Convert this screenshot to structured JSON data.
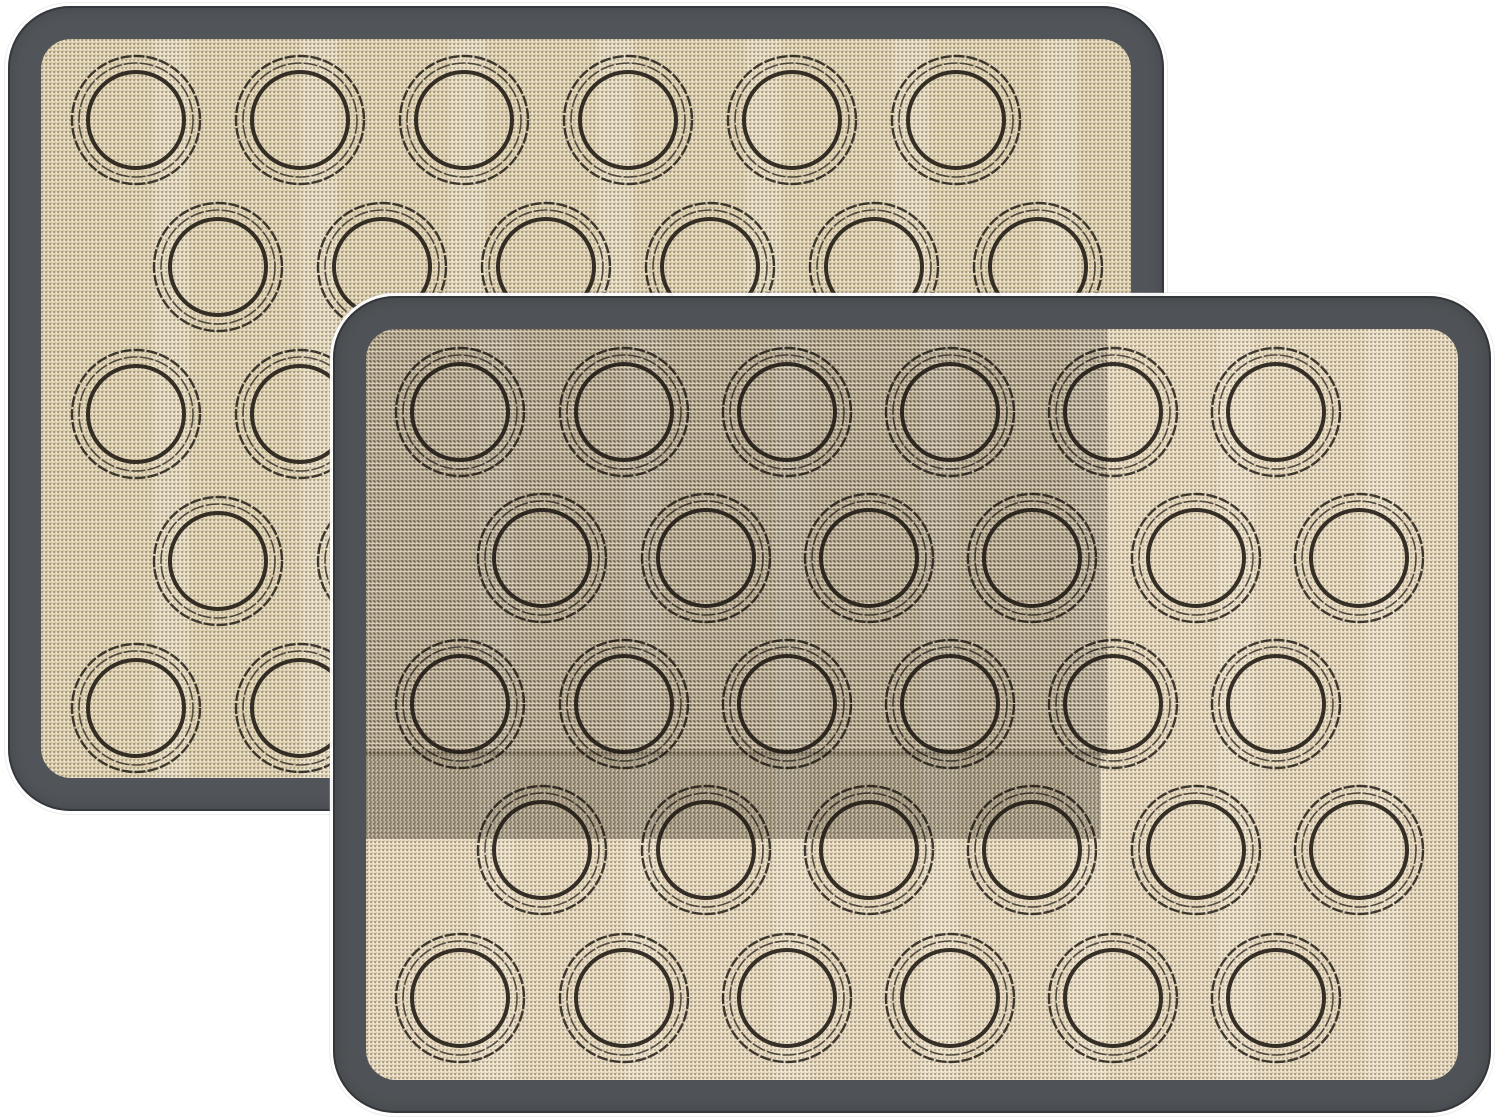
{
  "scene": {
    "type": "product-photo",
    "description": "Two overlapping rectangular silicone macaron baking mats on a white background. Each mat has a dark slate-gray rounded border frame and a speckled beige woven fiberglass surface printed with thirty double-ring macaron piping guide circles arranged in five staggered rows of six. The front mat covers the lower-right portion of the back mat and shows a darker woven moire region over its upper-left area and a denser horizontal band across its middle.",
    "background_color": "#ffffff",
    "image_width": 1498,
    "image_height": 1118,
    "mat_count": 2
  },
  "shared_pattern": {
    "rows": 5,
    "circles_per_row": 6,
    "total_circles_per_mat": 30,
    "row_stagger": "rows 1,3,5 aligned; rows 2,4 offset right by half a pitch",
    "circle_pitch_x": 164,
    "circle_pitch_y": 146,
    "ring_style": "two thin concentric outer rings with one bold inner ring"
  },
  "mats": [
    {
      "id": "back",
      "label": "back baking mat (upper left, partially hidden)",
      "x": 8,
      "y": 6,
      "width": 1156,
      "height": 805,
      "corner_radius": 62,
      "border_color": "#51555a",
      "border_thickness": 33,
      "surface_color": "#ddcfae",
      "surface_corner_radius": 30,
      "ring_color": "#17130e",
      "row_centers_y": [
        114,
        261,
        408,
        555,
        702
      ],
      "odd_row_centers_x": [
        128,
        292,
        456,
        620,
        784,
        948
      ],
      "even_row_centers_x": [
        210,
        374,
        538,
        702,
        866,
        1030
      ],
      "circle_radii": {
        "outer": 64,
        "middle": 57,
        "inner": 48
      },
      "shade_regions": []
    },
    {
      "id": "front",
      "label": "front baking mat (lower right, fully visible)",
      "x": 333,
      "y": 296,
      "width": 1158,
      "height": 817,
      "corner_radius": 62,
      "border_color": "#4f5357",
      "border_thickness": 33,
      "surface_color": "#e8d7b8",
      "surface_corner_radius": 30,
      "ring_color": "#17130e",
      "row_centers_y": [
        116,
        262,
        408,
        554,
        702
      ],
      "odd_row_centers_x": [
        127,
        291,
        454,
        617,
        780,
        943
      ],
      "even_row_centers_x": [
        209,
        373,
        536,
        699,
        863,
        1026
      ],
      "circle_radii": {
        "outer": 64,
        "middle": 57,
        "inner": 48
      },
      "shade_regions": [
        {
          "x": 32,
          "y": 32,
          "width": 742,
          "height": 428,
          "tint": "rgba(42,34,18,0.10)"
        },
        {
          "x": 32,
          "y": 455,
          "width": 736,
          "height": 88,
          "tint": "rgba(42,34,18,0.17)"
        }
      ]
    }
  ]
}
